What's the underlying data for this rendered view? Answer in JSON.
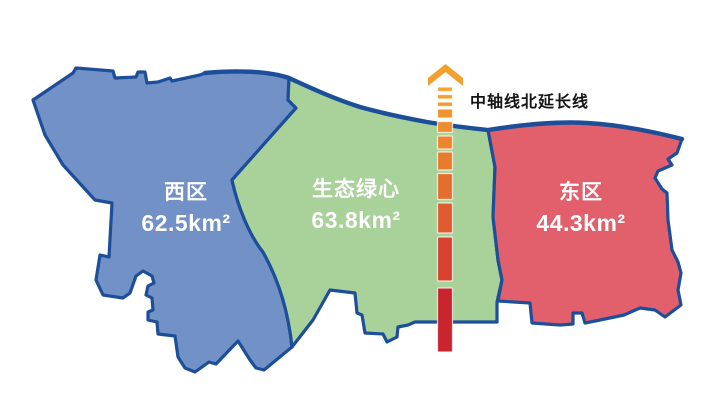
{
  "background": "#FFFFFF",
  "border_color": "#1D4E99",
  "regions": {
    "west": {
      "name": "西区",
      "area": "62.5km²",
      "color": "#7191C7"
    },
    "center": {
      "name": "生态绿心",
      "area": "63.8km²",
      "color": "#A8D29A"
    },
    "east": {
      "name": "东区",
      "area": "44.3km²",
      "color": "#E2606C"
    }
  },
  "axis_line": {
    "label": "中轴线北延长线",
    "arrow_color": "#F2A130",
    "x": 437.5,
    "width": 15,
    "dashes": [
      {
        "y": 87,
        "h": 4.5,
        "color": "#F5A42C"
      },
      {
        "y": 94.5,
        "h": 4.5,
        "color": "#F4A02E"
      },
      {
        "y": 102,
        "h": 4.5,
        "color": "#F29B2E"
      },
      {
        "y": 109,
        "h": 9,
        "color": "#F0952E"
      },
      {
        "y": 121.5,
        "h": 11,
        "color": "#EE8D2E"
      },
      {
        "y": 136,
        "h": 13,
        "color": "#EC852E"
      },
      {
        "y": 152,
        "h": 18,
        "color": "#E97B2F"
      },
      {
        "y": 173.5,
        "h": 26,
        "color": "#E56E2F"
      },
      {
        "y": 203,
        "h": 30,
        "color": "#E05C30"
      },
      {
        "y": 237,
        "h": 44,
        "color": "#D84331"
      },
      {
        "y": 288,
        "h": 64,
        "color": "#C9252E"
      }
    ]
  }
}
